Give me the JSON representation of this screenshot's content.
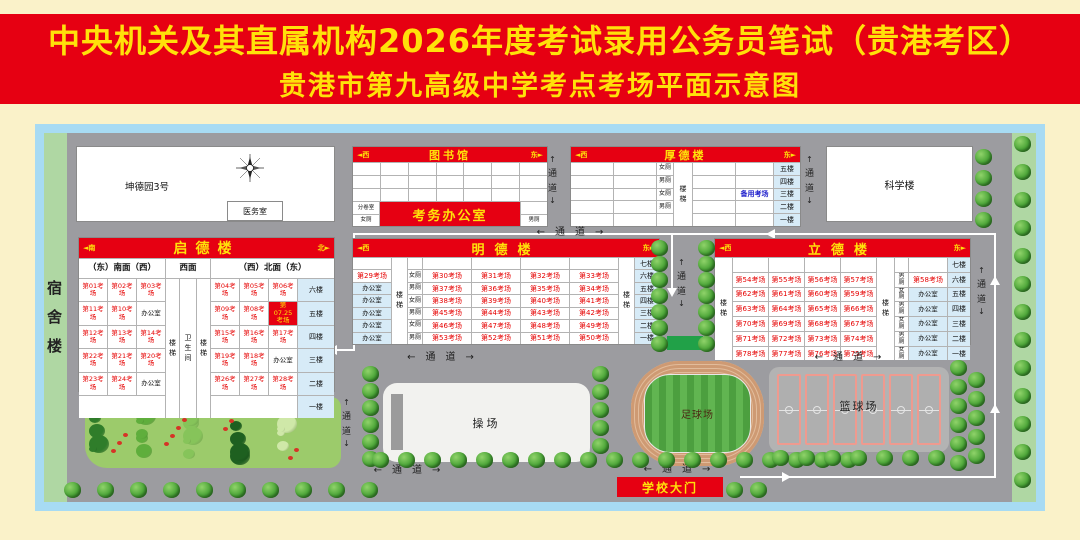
{
  "title": {
    "line1": "中央机关及其直属机构2026年度考试录用公务员笔试（贵港考区）",
    "line2": "贵港市第九高级中学考点考场平面示意图"
  },
  "corridor": {
    "h": "←　通　道　→",
    "up": "↑",
    "t1": "通",
    "t2": "道",
    "down": "↓"
  },
  "campus": {
    "dorm": "宿舍楼",
    "science": "科学楼",
    "kunde": "坤德园3号",
    "medical": "医务室",
    "playground": "操场",
    "football": "足球场",
    "basketball": "篮球场",
    "gate": "学校大门"
  },
  "library": {
    "dir_w": "◄西",
    "title": "图书馆",
    "dir_e": "东►",
    "fenjuan": "分卷室",
    "nv": "女厕",
    "nan": "男厕",
    "office": "考务办公室"
  },
  "houde": {
    "dir_w": "◄西",
    "title": "厚德楼",
    "dir_e": "东►",
    "stairs": "楼梯",
    "backup": "备用考场",
    "toilets": [
      "女厕",
      "男厕",
      "女厕",
      "男厕"
    ],
    "floors": [
      "五楼",
      "四楼",
      "三楼",
      "二楼",
      "一楼"
    ]
  },
  "qide": {
    "dir_s": "◄南",
    "title": "启德楼",
    "dir_n": "北►",
    "sub_south": "（东）南面（西）",
    "sub_west": "西面",
    "sub_north": "（西）北面（东）",
    "stairs": "楼梯",
    "restroom": "卫生间",
    "rows": [
      {
        "l1": "第01考场",
        "l2": "第02考场",
        "l3": "第03考场",
        "r1": "第04考场",
        "r2": "第05考场",
        "r3": "第06考场",
        "floor": "六楼"
      },
      {
        "l1": "第11考场",
        "l2": "第10考场",
        "l3": "办公室",
        "r1": "第09考场",
        "r2": "第08考场",
        "r3": "第07.25考场",
        "floor": "五楼"
      },
      {
        "l1": "第12考场",
        "l2": "第13考场",
        "l3": "第14考场",
        "r1": "第15考场",
        "r2": "第16考场",
        "r3": "第17考场",
        "floor": "四楼"
      },
      {
        "l1": "第22考场",
        "l2": "第21考场",
        "l3": "第20考场",
        "r1": "第19考场",
        "r2": "第18考场",
        "r3": "办公室",
        "floor": "三楼"
      },
      {
        "l1": "第23考场",
        "l2": "第24考场",
        "l3": "办公室",
        "r1": "第26考场",
        "r2": "第27考场",
        "r3": "第28考场",
        "floor": "二楼"
      },
      {
        "floor": "一楼"
      }
    ]
  },
  "mingde": {
    "dir_w": "◄西",
    "title": "明德楼",
    "dir_e": "东►",
    "stairs": "楼梯",
    "rows": [
      {
        "floor": "七楼"
      },
      {
        "c1": "第29考场",
        "wc": "女厕",
        "e1": "第30考场",
        "e2": "第31考场",
        "e3": "第32考场",
        "e4": "第33考场",
        "floor": "六楼"
      },
      {
        "c1": "办公室",
        "wc": "男厕",
        "e1": "第37考场",
        "e2": "第36考场",
        "e3": "第35考场",
        "e4": "第34考场",
        "floor": "五楼"
      },
      {
        "c1": "办公室",
        "wc": "女厕",
        "e1": "第38考场",
        "e2": "第39考场",
        "e3": "第40考场",
        "e4": "第41考场",
        "floor": "四楼"
      },
      {
        "c1": "办公室",
        "wc": "男厕",
        "e1": "第45考场",
        "e2": "第44考场",
        "e3": "第43考场",
        "e4": "第42考场",
        "floor": "三楼"
      },
      {
        "c1": "办公室",
        "wc": "女厕",
        "e1": "第46考场",
        "e2": "第47考场",
        "e3": "第48考场",
        "e4": "第49考场",
        "floor": "二楼"
      },
      {
        "c1": "办公室",
        "wc": "男厕",
        "e1": "第53考场",
        "e2": "第52考场",
        "e3": "第51考场",
        "e4": "第50考场",
        "floor": "一楼"
      }
    ]
  },
  "lide": {
    "dir_w": "◄西",
    "title": "立德楼",
    "dir_e": "东►",
    "stairs": "楼梯",
    "rows": [
      {
        "floor": "七楼"
      },
      {
        "e1": "第54考场",
        "e2": "第55考场",
        "e3": "第56考场",
        "e4": "第57考场",
        "wc": "男厕",
        "c8": "第58考场",
        "floor": "六楼"
      },
      {
        "e1": "第62考场",
        "e2": "第61考场",
        "e3": "第60考场",
        "e4": "第59考场",
        "wc": "女厕",
        "c8": "办公室",
        "floor": "五楼"
      },
      {
        "e1": "第63考场",
        "e2": "第64考场",
        "e3": "第65考场",
        "e4": "第66考场",
        "wc": "男厕",
        "c8": "办公室",
        "floor": "四楼"
      },
      {
        "e1": "第70考场",
        "e2": "第69考场",
        "e3": "第68考场",
        "e4": "第67考场",
        "wc": "女厕",
        "c8": "办公室",
        "floor": "三楼"
      },
      {
        "e1": "第71考场",
        "e2": "第72考场",
        "e3": "第73考场",
        "e4": "第74考场",
        "wc": "男厕",
        "c8": "办公室",
        "floor": "二楼"
      },
      {
        "e1": "第78考场",
        "e2": "第77考场",
        "e3": "第76考场",
        "e4": "第75考场",
        "wc": "女厕",
        "c8": "办公室",
        "floor": "一楼"
      }
    ]
  }
}
